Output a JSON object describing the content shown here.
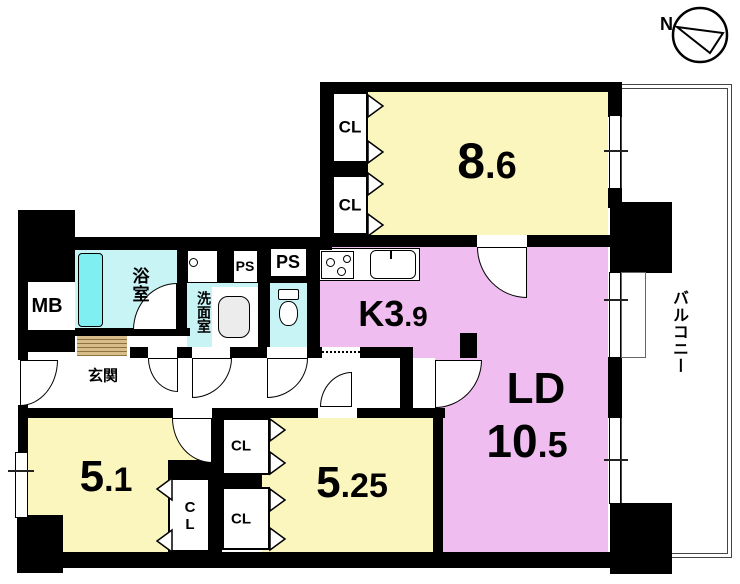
{
  "compass": {
    "north_label": "N"
  },
  "balcony": {
    "label": "バルコニー"
  },
  "rooms": {
    "bedroom_86": {
      "area_main": "8",
      "area_dec": ".6"
    },
    "kitchen": {
      "label_main": "K3",
      "label_dec": ".9"
    },
    "living_dining": {
      "name": "LD",
      "area_main": "10",
      "area_dec": ".5"
    },
    "bedroom_51": {
      "area_main": "5",
      "area_dec": ".1"
    },
    "bedroom_525": {
      "area_main": "5",
      "area_dec": ".25"
    },
    "bath": {
      "label": "浴室"
    },
    "washroom": {
      "label": "洗面室"
    },
    "entrance": {
      "label": "玄関"
    }
  },
  "labels": {
    "closet": "CL",
    "pipe_space": "PS",
    "meter_box": "MB"
  },
  "colors": {
    "wall": "#000000",
    "room_yellow": "#FBF6BE",
    "room_pink": "#EFBDF0",
    "wet_area_cyan": "#C9F4F6",
    "bathtub_cyan": "#7FEFF2",
    "wood_step": "#D8BC8A"
  }
}
